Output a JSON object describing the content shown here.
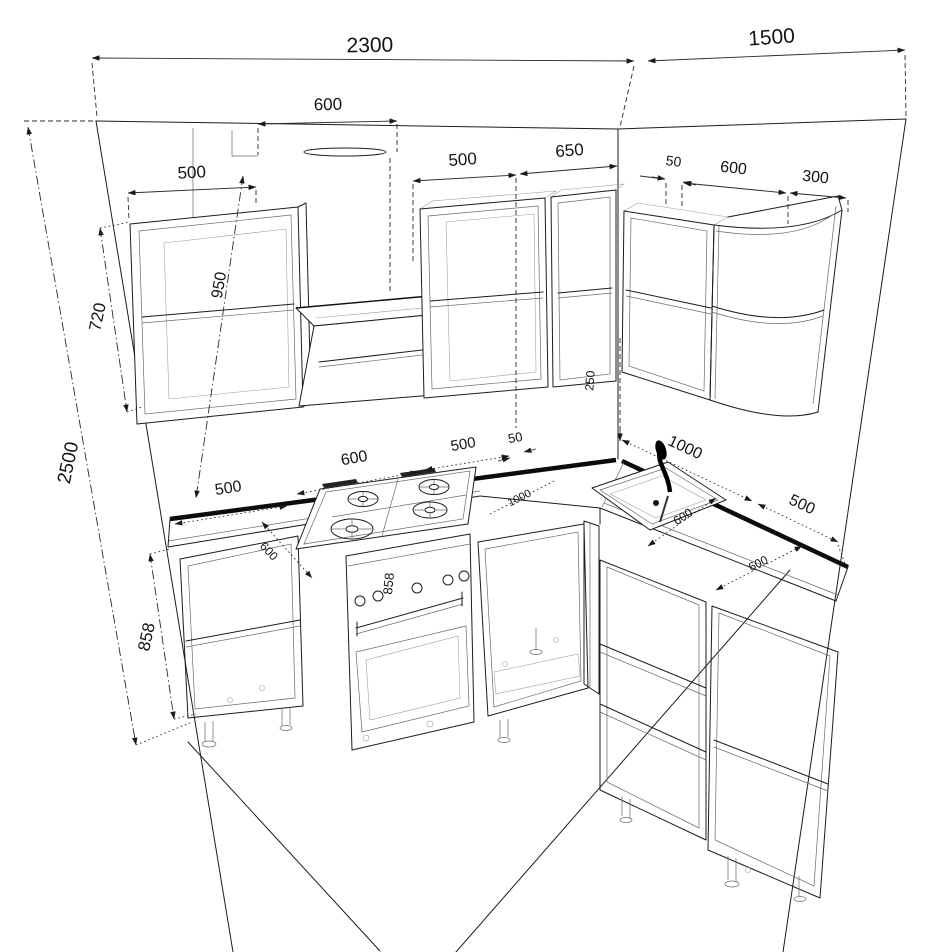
{
  "drawing": {
    "title": "kitchen-corner-perspective-elevation",
    "units": "mm",
    "line_color": "#1c1c1c",
    "background": "#ffffff"
  },
  "dims": {
    "back_wall": "2300",
    "right_wall": "1500",
    "hood_width": "600",
    "upper_left_width": "500",
    "upper_mid_width": "500",
    "upper_mid2_width": "650",
    "upper_filler": "50",
    "upper_right_width": "600",
    "upper_end_width": "300",
    "room_height": "2500",
    "upper_height": "720",
    "hood_to_counter": "950",
    "corner_gap": "250",
    "base_left_width": "500",
    "stove_width": "600",
    "base_mid_width": "500",
    "base_filler": "50",
    "right_run": "1000",
    "right_base_width": "500",
    "base_height": "858",
    "oven_height": "858",
    "depth_left": "600",
    "corner_run": "1000",
    "depth_sink": "600",
    "depth_right": "600"
  }
}
